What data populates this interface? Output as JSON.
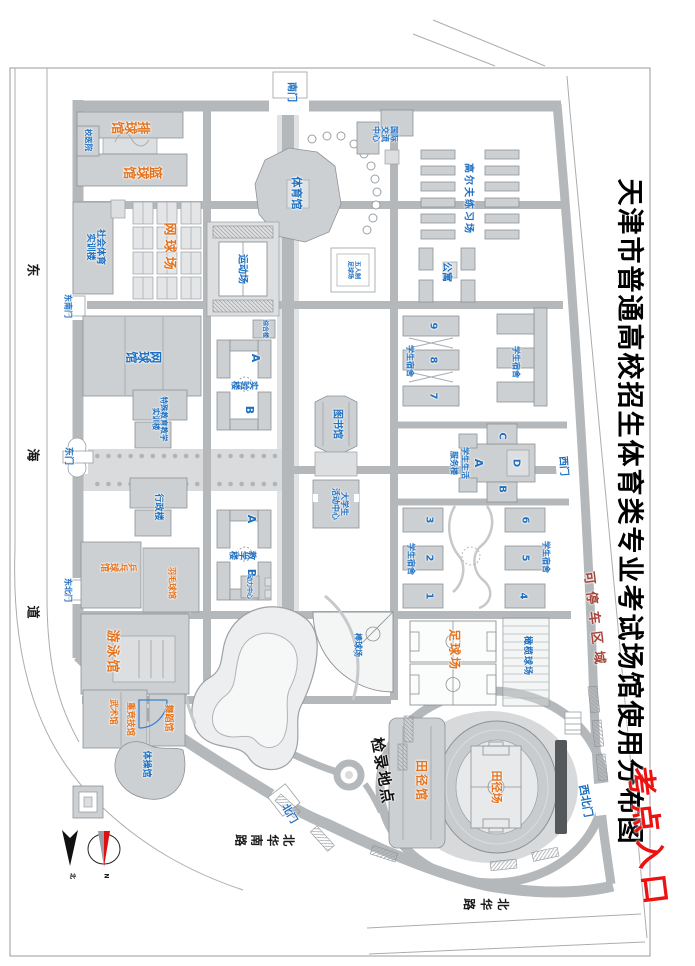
{
  "map": {
    "title": "天津市普通高校招生体育类专业考试场馆使用分布图",
    "exam_entrance": "考点入口",
    "parking_area": "可停车区域",
    "checkin_point": "检录地点"
  },
  "roads": {
    "donghai_dao": "东海道",
    "beihua_road": "北华路",
    "beihua_south_road": "北华南路"
  },
  "compass": {
    "n": "N",
    "north": "北"
  },
  "labels": [
    {
      "n": "gate-south",
      "t": "南门",
      "x": 92,
      "y": 404,
      "s": 10,
      "c": "b"
    },
    {
      "n": "gate-west",
      "t": "西门",
      "x": 466,
      "y": 132,
      "s": 10,
      "c": "b",
      "r": -4
    },
    {
      "n": "gate-northwest",
      "t": "西北门",
      "x": 801,
      "y": 110,
      "s": 11,
      "c": "b",
      "r": -10
    },
    {
      "n": "gate-north",
      "t": "北门",
      "x": 814,
      "y": 406,
      "s": 10,
      "c": "b",
      "r": -30
    },
    {
      "n": "gate-east",
      "t": "东门",
      "x": 456,
      "y": 627,
      "s": 9,
      "c": "b"
    },
    {
      "n": "gate-southeast",
      "t": "东南门",
      "x": 306,
      "y": 628,
      "s": 8,
      "c": "b"
    },
    {
      "n": "gate-northeast",
      "t": "东北门",
      "x": 590,
      "y": 628,
      "s": 8,
      "c": "b"
    },
    {
      "n": "venue-volleyball",
      "t": "排球馆",
      "x": 125,
      "y": 564,
      "s": 13,
      "c": "o",
      "v": 1
    },
    {
      "n": "venue-basketball",
      "t": "篮球馆",
      "x": 170,
      "y": 552,
      "s": 13,
      "c": "o",
      "v": 1
    },
    {
      "n": "venue-tennis-courts",
      "t": "网球场",
      "x": 248,
      "y": 527,
      "s": 13,
      "c": "o",
      "ls": 4
    },
    {
      "n": "venue-table-tennis",
      "t": "乒乓球馆",
      "x": 566,
      "y": 576,
      "s": 9,
      "c": "o",
      "v": 1
    },
    {
      "n": "venue-badminton",
      "t": "羽毛球馆",
      "x": 583,
      "y": 524,
      "s": 8,
      "c": "o"
    },
    {
      "n": "venue-swimming",
      "t": "游泳馆",
      "x": 652,
      "y": 584,
      "s": 13,
      "c": "o",
      "ls": 2
    },
    {
      "n": "venue-wushu",
      "t": "武术馆",
      "x": 712,
      "y": 583,
      "s": 8.5,
      "c": "o"
    },
    {
      "n": "venue-heavy-athletics",
      "t": "重竞技馆",
      "x": 719,
      "y": 566,
      "s": 8.5,
      "c": "o"
    },
    {
      "n": "venue-dance",
      "t": "舞蹈馆",
      "x": 718,
      "y": 527,
      "s": 9,
      "c": "o"
    },
    {
      "n": "venue-football",
      "t": "足球场",
      "x": 650,
      "y": 241,
      "s": 12,
      "c": "o",
      "ls": 2
    },
    {
      "n": "venue-athletics-hall",
      "t": "田径馆",
      "x": 781,
      "y": 274,
      "s": 12,
      "c": "o",
      "ls": 2
    },
    {
      "n": "venue-athletics-field",
      "t": "田径场",
      "x": 787,
      "y": 199,
      "s": 11,
      "c": "o"
    },
    {
      "n": "bld-campus-hospital",
      "t": "校医院",
      "x": 140,
      "y": 607,
      "s": 7.5,
      "c": "b"
    },
    {
      "n": "bld-social-sports-training",
      "L": [
        "社会体育",
        "实训楼"
      ],
      "x": 247,
      "y": 600,
      "s": 9,
      "c": "b"
    },
    {
      "n": "bld-sports-ground",
      "t": "运动场",
      "x": 269,
      "y": 453,
      "s": 10,
      "c": "b"
    },
    {
      "n": "bld-gymnasium",
      "t": "体育馆",
      "x": 193,
      "y": 399,
      "s": 11,
      "c": "b"
    },
    {
      "n": "bld-futsal",
      "L": [
        "五人制",
        "足球场"
      ],
      "x": 270,
      "y": 342,
      "s": 6,
      "c": "b"
    },
    {
      "n": "bld-intl-exchange",
      "L": [
        "国际",
        "交流",
        "中心"
      ],
      "x": 134,
      "y": 311,
      "s": 8,
      "c": "b"
    },
    {
      "n": "bld-golf-range",
      "t": "高尔夫练习场",
      "x": 199,
      "y": 227,
      "s": 10,
      "c": "b",
      "ls": 2
    },
    {
      "n": "bld-apartments",
      "t": "公寓",
      "x": 272,
      "y": 249,
      "s": 10,
      "c": "b"
    },
    {
      "n": "bld-tennis-hall",
      "t": "网球馆",
      "x": 356,
      "y": 551,
      "s": 12,
      "c": "b",
      "v": 1
    },
    {
      "n": "bld-special-edu",
      "L": [
        "特殊教育教学",
        "实训楼"
      ],
      "x": 419,
      "y": 536,
      "s": 7.5,
      "c": "b"
    },
    {
      "n": "bld-admin",
      "t": "行政楼",
      "x": 507,
      "y": 537,
      "s": 9,
      "c": "b"
    },
    {
      "n": "bld-lab",
      "t": "实验楼",
      "x": 384,
      "y": 450,
      "s": 9,
      "c": "b",
      "v": 1
    },
    {
      "n": "bld-lab-a",
      "t": "A",
      "x": 358,
      "y": 440,
      "s": 11,
      "c": "b"
    },
    {
      "n": "bld-lab-b",
      "t": "B",
      "x": 410,
      "y": 446,
      "s": 11,
      "c": "b"
    },
    {
      "n": "bld-teaching",
      "t": "教学楼",
      "x": 554,
      "y": 452,
      "s": 9,
      "c": "b",
      "v": 1
    },
    {
      "n": "bld-teaching-a",
      "t": "A",
      "x": 519,
      "y": 444,
      "s": 11,
      "c": "b"
    },
    {
      "n": "bld-teaching-b",
      "t": "B",
      "x": 573,
      "y": 444,
      "s": 11,
      "c": "b"
    },
    {
      "n": "bld-complex",
      "t": "综合楼",
      "x": 329,
      "y": 431,
      "s": 6,
      "c": "b"
    },
    {
      "n": "bld-library",
      "t": "图书馆",
      "x": 424,
      "y": 358,
      "s": 10,
      "c": "b"
    },
    {
      "n": "bld-student-activity",
      "L": [
        "大学生",
        "活动中心"
      ],
      "x": 504,
      "y": 356,
      "s": 8,
      "c": "b"
    },
    {
      "n": "dorm-789-label",
      "t": "学生宿舍",
      "x": 361,
      "y": 286,
      "s": 8,
      "c": "b"
    },
    {
      "n": "dorm-9",
      "t": "9",
      "x": 326,
      "y": 262,
      "s": 10,
      "c": "b"
    },
    {
      "n": "dorm-8",
      "t": "8",
      "x": 360,
      "y": 262,
      "s": 10,
      "c": "b"
    },
    {
      "n": "dorm-7",
      "t": "7",
      "x": 396,
      "y": 262,
      "s": 10,
      "c": "b"
    },
    {
      "n": "dorm-nw-label",
      "t": "学生宿舍",
      "x": 362,
      "y": 180,
      "s": 8,
      "c": "b"
    },
    {
      "n": "svc-d",
      "t": "D",
      "x": 463,
      "y": 179,
      "s": 10,
      "c": "b"
    },
    {
      "n": "svc-c",
      "t": "C",
      "x": 436,
      "y": 193,
      "s": 10,
      "c": "b"
    },
    {
      "n": "svc-b",
      "t": "B",
      "x": 489,
      "y": 193,
      "s": 10,
      "c": "b"
    },
    {
      "n": "svc-a",
      "t": "A",
      "x": 463,
      "y": 217,
      "s": 11,
      "c": "b"
    },
    {
      "n": "svc-label-1",
      "t": "学生生活",
      "x": 463,
      "y": 231,
      "s": 8,
      "c": "b"
    },
    {
      "n": "svc-label-2",
      "t": "服务楼",
      "x": 463,
      "y": 242,
      "s": 8,
      "c": "b"
    },
    {
      "n": "dorm-456-label",
      "t": "学生宿舍",
      "x": 557,
      "y": 150,
      "s": 8,
      "c": "b"
    },
    {
      "n": "dorm-6",
      "t": "6",
      "x": 520,
      "y": 170,
      "s": 10,
      "c": "b"
    },
    {
      "n": "dorm-5",
      "t": "5",
      "x": 558,
      "y": 170,
      "s": 10,
      "c": "b"
    },
    {
      "n": "dorm-4",
      "t": "4",
      "x": 596,
      "y": 172,
      "s": 10,
      "c": "b"
    },
    {
      "n": "dorm-123-label",
      "t": "学生宿舍",
      "x": 559,
      "y": 285,
      "s": 8,
      "c": "b"
    },
    {
      "n": "dorm-3",
      "t": "3",
      "x": 520,
      "y": 266,
      "s": 10,
      "c": "b"
    },
    {
      "n": "dorm-2",
      "t": "2",
      "x": 558,
      "y": 266,
      "s": 10,
      "c": "b"
    },
    {
      "n": "dorm-1",
      "t": "1",
      "x": 596,
      "y": 266,
      "s": 10,
      "c": "b"
    },
    {
      "n": "bld-rugby",
      "t": "橄榄球场",
      "x": 656,
      "y": 168,
      "s": 9,
      "c": "b",
      "ls": 1
    },
    {
      "n": "bld-baseball",
      "t": "棒球场",
      "x": 645,
      "y": 338,
      "s": 8,
      "c": "b"
    },
    {
      "n": "bld-gymnastics",
      "t": "体操馆",
      "x": 764,
      "y": 549,
      "s": 9,
      "c": "b"
    },
    {
      "n": "bld-utility",
      "t": "动力中心",
      "x": 587,
      "y": 447,
      "s": 6,
      "c": "b"
    },
    {
      "n": "road-donghai-char-1",
      "t": "东",
      "x": 270,
      "y": 664,
      "s": 13,
      "c": "k"
    },
    {
      "n": "road-donghai-char-2",
      "t": "海",
      "x": 455,
      "y": 664,
      "s": 13,
      "c": "k"
    },
    {
      "n": "road-donghai-char-3",
      "t": "道",
      "x": 612,
      "y": 664,
      "s": 13,
      "c": "k"
    },
    {
      "n": "road-beihua-label",
      "t": "北华路",
      "x": 903,
      "y": 211,
      "s": 12,
      "c": "k",
      "v": 1,
      "ls": 5
    },
    {
      "n": "road-beihua-south-label",
      "t": "北华南路",
      "x": 839,
      "y": 432,
      "s": 12,
      "c": "k",
      "v": 1,
      "ls": 4
    },
    {
      "n": "compass-n-letter",
      "t": "N",
      "x": 876,
      "y": 590,
      "s": 6,
      "c": "k"
    },
    {
      "n": "compass-north-letter",
      "t": "北",
      "x": 876,
      "y": 624,
      "s": 6,
      "c": "k"
    }
  ]
}
